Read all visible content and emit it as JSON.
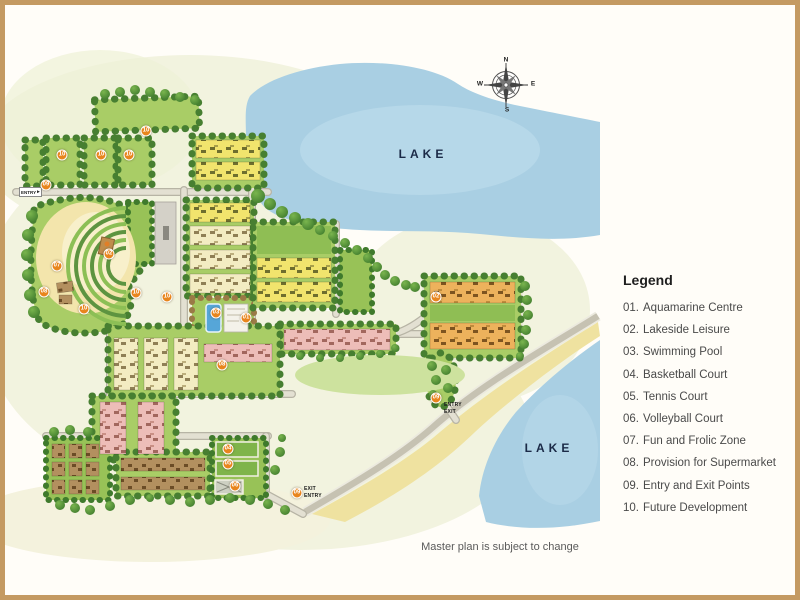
{
  "page": {
    "footnote": "Master plan is subject to change"
  },
  "map": {
    "lake_top_label": "LAKE",
    "lake_bottom_label": "LAKE",
    "compass": {
      "n": "N",
      "e": "E",
      "s": "S",
      "w": "W"
    },
    "entry_left": "ENTRY",
    "entry_labels": [
      {
        "text": "ENTRY",
        "x": 444,
        "y": 405
      },
      {
        "text": "EXIT",
        "x": 444,
        "y": 412
      },
      {
        "text": "EXIT",
        "x": 304,
        "y": 489
      },
      {
        "text": "ENTRY",
        "x": 304,
        "y": 496
      }
    ],
    "markers": [
      {
        "num": "10",
        "x": 62,
        "y": 155
      },
      {
        "num": "10",
        "x": 101,
        "y": 155
      },
      {
        "num": "10",
        "x": 129,
        "y": 155
      },
      {
        "num": "10",
        "x": 146,
        "y": 131
      },
      {
        "num": "09",
        "x": 46,
        "y": 185
      },
      {
        "num": "02",
        "x": 109,
        "y": 254
      },
      {
        "num": "07",
        "x": 57,
        "y": 266
      },
      {
        "num": "08",
        "x": 44,
        "y": 292
      },
      {
        "num": "10",
        "x": 84,
        "y": 309
      },
      {
        "num": "10",
        "x": 136,
        "y": 293
      },
      {
        "num": "10",
        "x": 167,
        "y": 297
      },
      {
        "num": "03",
        "x": 216,
        "y": 313
      },
      {
        "num": "01",
        "x": 246,
        "y": 318
      },
      {
        "num": "08",
        "x": 222,
        "y": 365
      },
      {
        "num": "02",
        "x": 436,
        "y": 297
      },
      {
        "num": "09",
        "x": 436,
        "y": 398
      },
      {
        "num": "04",
        "x": 228,
        "y": 449
      },
      {
        "num": "05",
        "x": 228,
        "y": 464
      },
      {
        "num": "06",
        "x": 235,
        "y": 486
      },
      {
        "num": "09",
        "x": 297,
        "y": 493
      }
    ],
    "colors": {
      "frame": "#c49a62",
      "lake": "#a9cfe3",
      "marker": "#e8851d"
    }
  },
  "legend": {
    "title": "Legend",
    "items": [
      {
        "num": "01.",
        "label": "Aquamarine Centre"
      },
      {
        "num": "02.",
        "label": "Lakeside Leisure"
      },
      {
        "num": "03.",
        "label": "Swimming Pool"
      },
      {
        "num": "04.",
        "label": "Basketball Court"
      },
      {
        "num": "05.",
        "label": "Tennis Court"
      },
      {
        "num": "06.",
        "label": "Volleyball Court"
      },
      {
        "num": "07.",
        "label": "Fun and Frolic Zone"
      },
      {
        "num": "08.",
        "label": "Provision for Supermarket"
      },
      {
        "num": "09.",
        "label": "Entry and Exit Points"
      },
      {
        "num": "10.",
        "label": "Future Development"
      }
    ]
  }
}
